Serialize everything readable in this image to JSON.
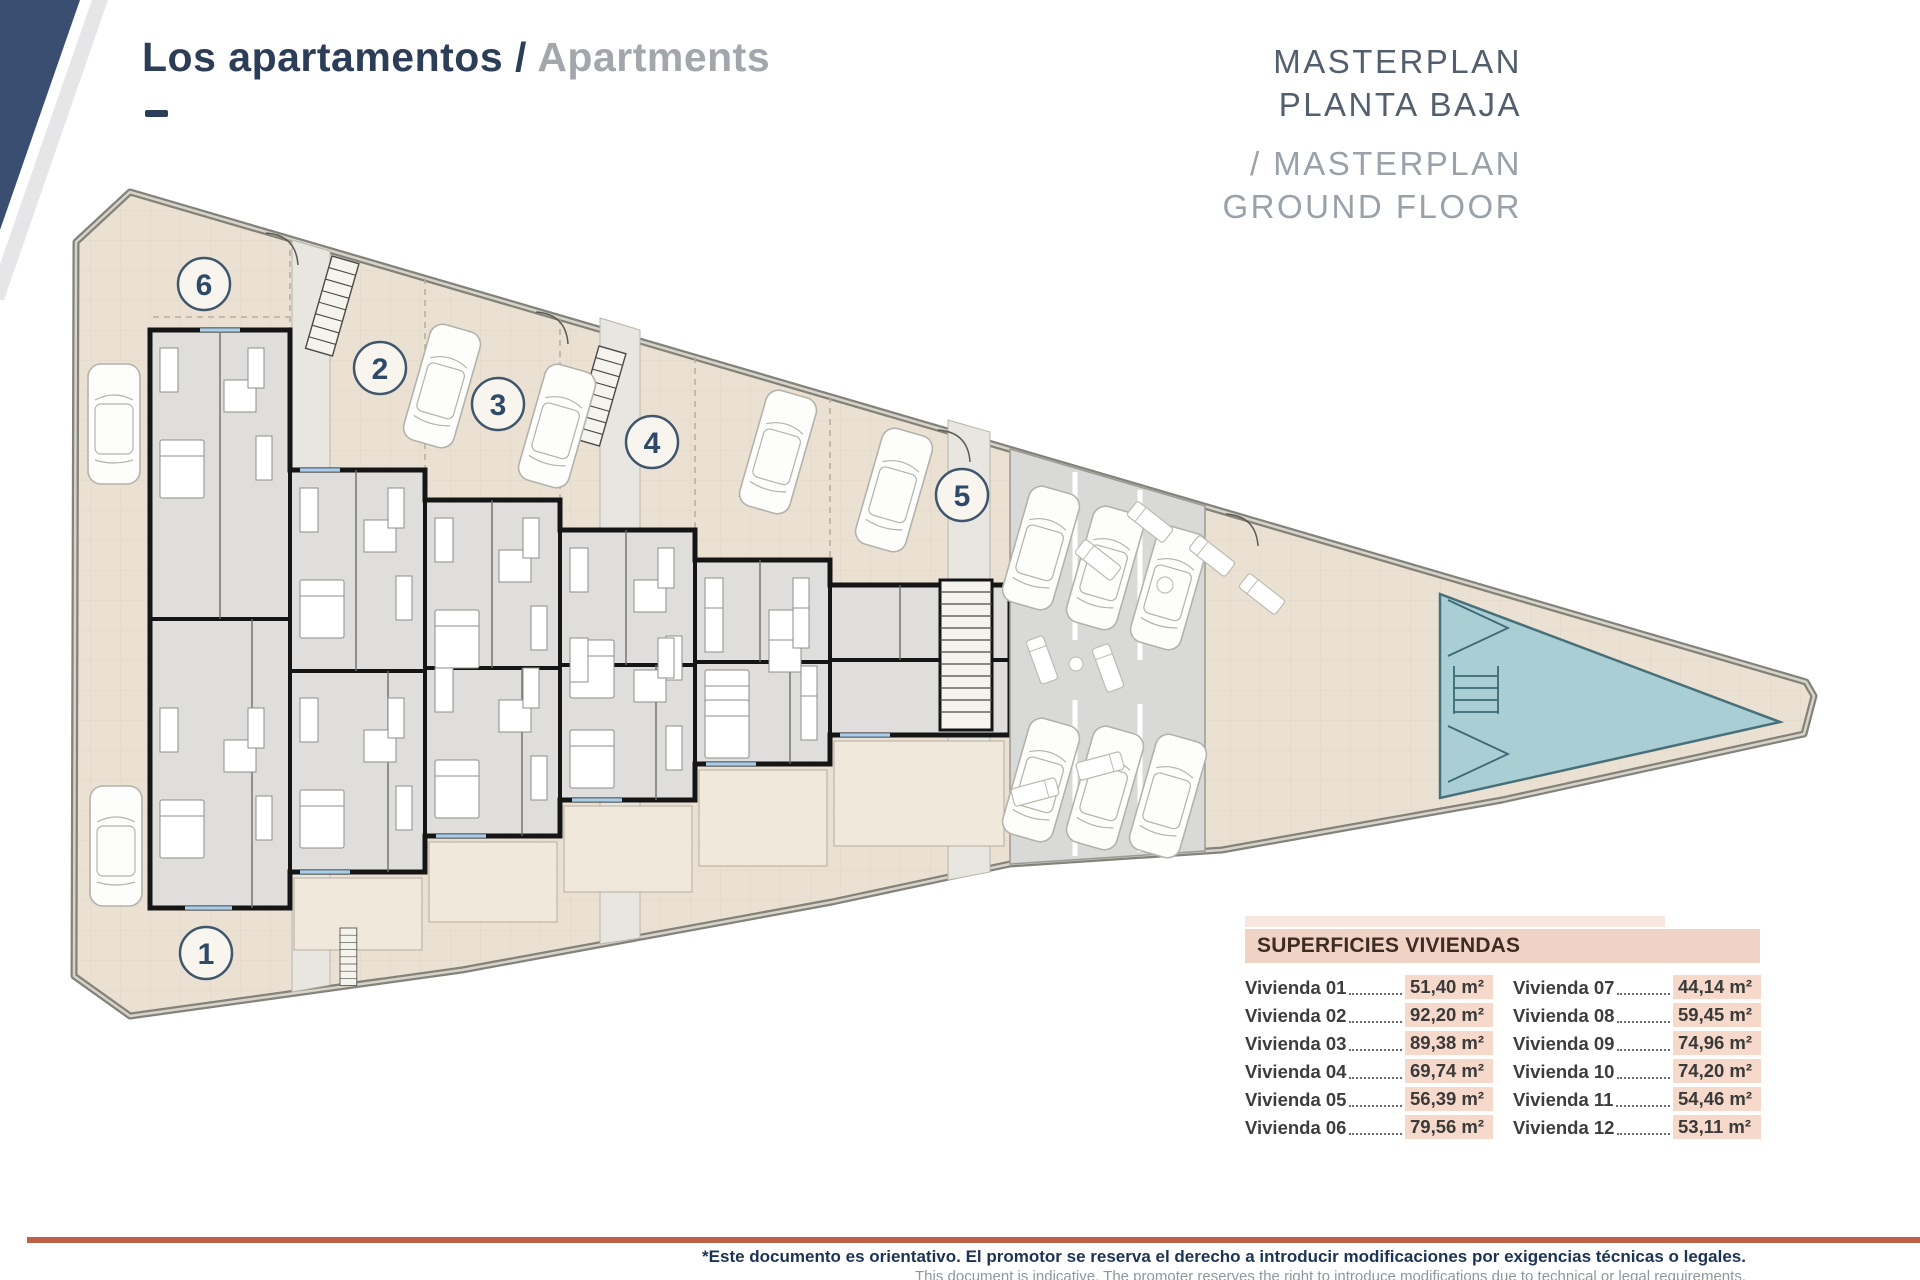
{
  "header": {
    "title_primary": "Los apartamentos",
    "title_separator": " / ",
    "title_secondary": "Apartments",
    "masterplan_line1": "MASTERPLAN",
    "masterplan_line2": "PLANTA BAJA",
    "masterplan_line3": "/ MASTERPLAN",
    "masterplan_line4": "GROUND FLOOR"
  },
  "plan": {
    "units": [
      "1",
      "2",
      "3",
      "4",
      "5",
      "6"
    ]
  },
  "table": {
    "title": "SUPERFICIES VIVIENDAS",
    "columns": [
      [
        {
          "label": "Vivienda 01",
          "value": "51,40 m²"
        },
        {
          "label": "Vivienda 02",
          "value": "92,20 m²"
        },
        {
          "label": "Vivienda 03",
          "value": "89,38 m²"
        },
        {
          "label": "Vivienda 04",
          "value": "69,74 m²"
        },
        {
          "label": "Vivienda 05",
          "value": "56,39 m²"
        },
        {
          "label": "Vivienda 06",
          "value": "79,56 m²"
        }
      ],
      [
        {
          "label": "Vivienda 07",
          "value": "44,14 m²"
        },
        {
          "label": "Vivienda 08",
          "value": "59,45 m²"
        },
        {
          "label": "Vivienda 09",
          "value": "74,96 m²"
        },
        {
          "label": "Vivienda 10",
          "value": "74,20 m²"
        },
        {
          "label": "Vivienda 11",
          "value": "54,46 m²"
        },
        {
          "label": "Vivienda 12",
          "value": "53,11 m²"
        }
      ]
    ]
  },
  "footer": {
    "disclaimer_es": "*Este documento es orientativo. El promotor se reserva el derecho a introducir modificaciones por exigencias técnicas o legales.",
    "disclaimer_en": "This document is indicative. The promoter reserves the right to introduce modifications due to technical or legal requirements."
  },
  "colors": {
    "navy": "#3a4e71",
    "title_blue": "#2c3e57",
    "title_gray": "#a3a7ab",
    "terrace": "#eae1d3",
    "interior": "#dfdedc",
    "wall": "#151515",
    "parking": "#d9d9d7",
    "pool": "#a9ced4",
    "pool_line": "#44707c",
    "accent_rule": "#bf6049",
    "table_header_bg": "#f1d3c5",
    "value_chip_bg": "#f6d9cb"
  }
}
